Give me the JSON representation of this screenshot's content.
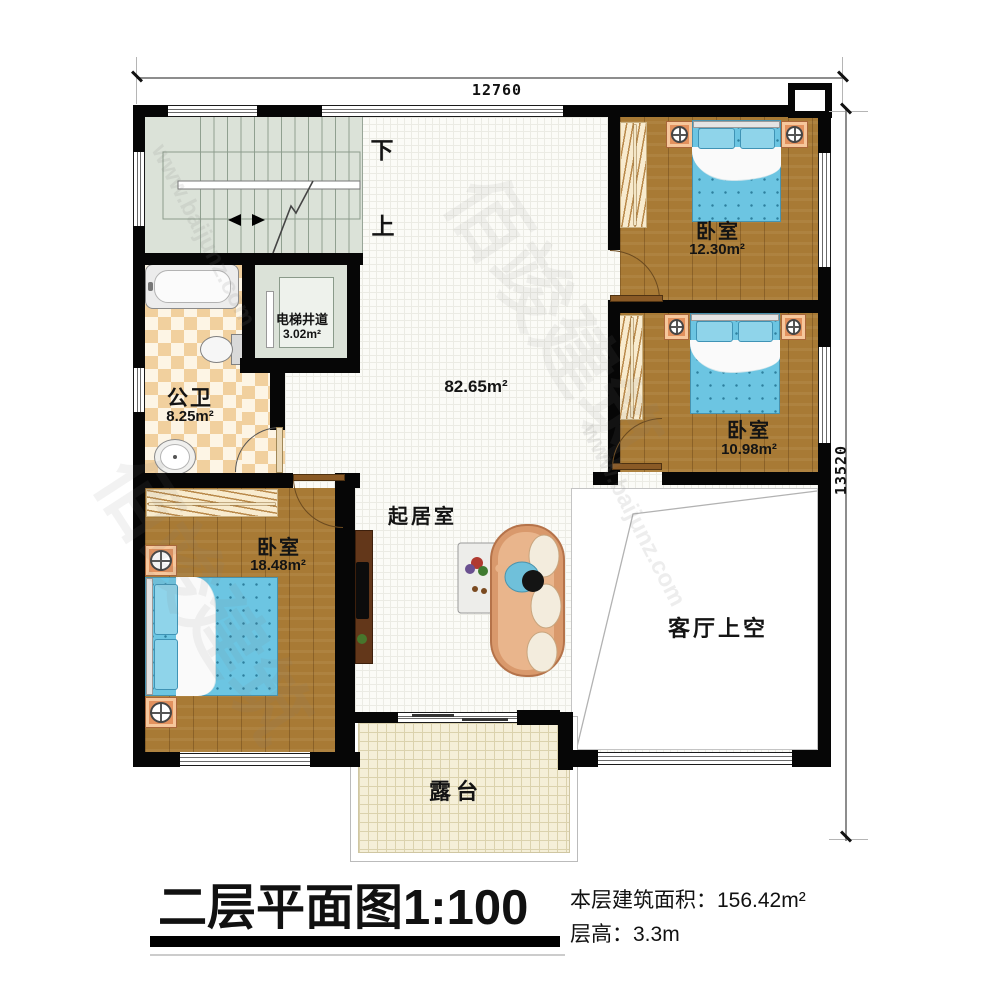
{
  "dims": {
    "top": "12760",
    "right": "13520"
  },
  "stairs": {
    "down": "下",
    "up": "上"
  },
  "rooms": {
    "living": {
      "name": "起居室",
      "area": "82.65m²"
    },
    "void": {
      "name": "客厅上空"
    },
    "terrace": {
      "name": "露台"
    },
    "bedroom_top_right": {
      "name": "卧室",
      "area": "12.30m²"
    },
    "bedroom_mid_right": {
      "name": "卧室",
      "area": "10.98m²"
    },
    "bedroom_bottom_left": {
      "name": "卧室",
      "area": "18.48m²"
    },
    "bathroom": {
      "name": "公卫",
      "area": "8.25m²"
    },
    "elevator": {
      "name": "电梯井道",
      "area": "3.02m²"
    }
  },
  "title": {
    "main": "二层平面图",
    "scale": "1:100",
    "area_label": "本层建筑面积：",
    "area_value": "156.42m²",
    "height_label": "层高：",
    "height_value": "3.3m"
  },
  "watermark": {
    "url": "www.baijunz.com",
    "brand": "佰竣建筑"
  },
  "colors": {
    "wall": "#060606",
    "wood": "#a87a35",
    "stair": "#dbe2d8",
    "checker": "#f1d09e",
    "bed": "#6cc5e2",
    "terrace": "#f5efd8"
  }
}
